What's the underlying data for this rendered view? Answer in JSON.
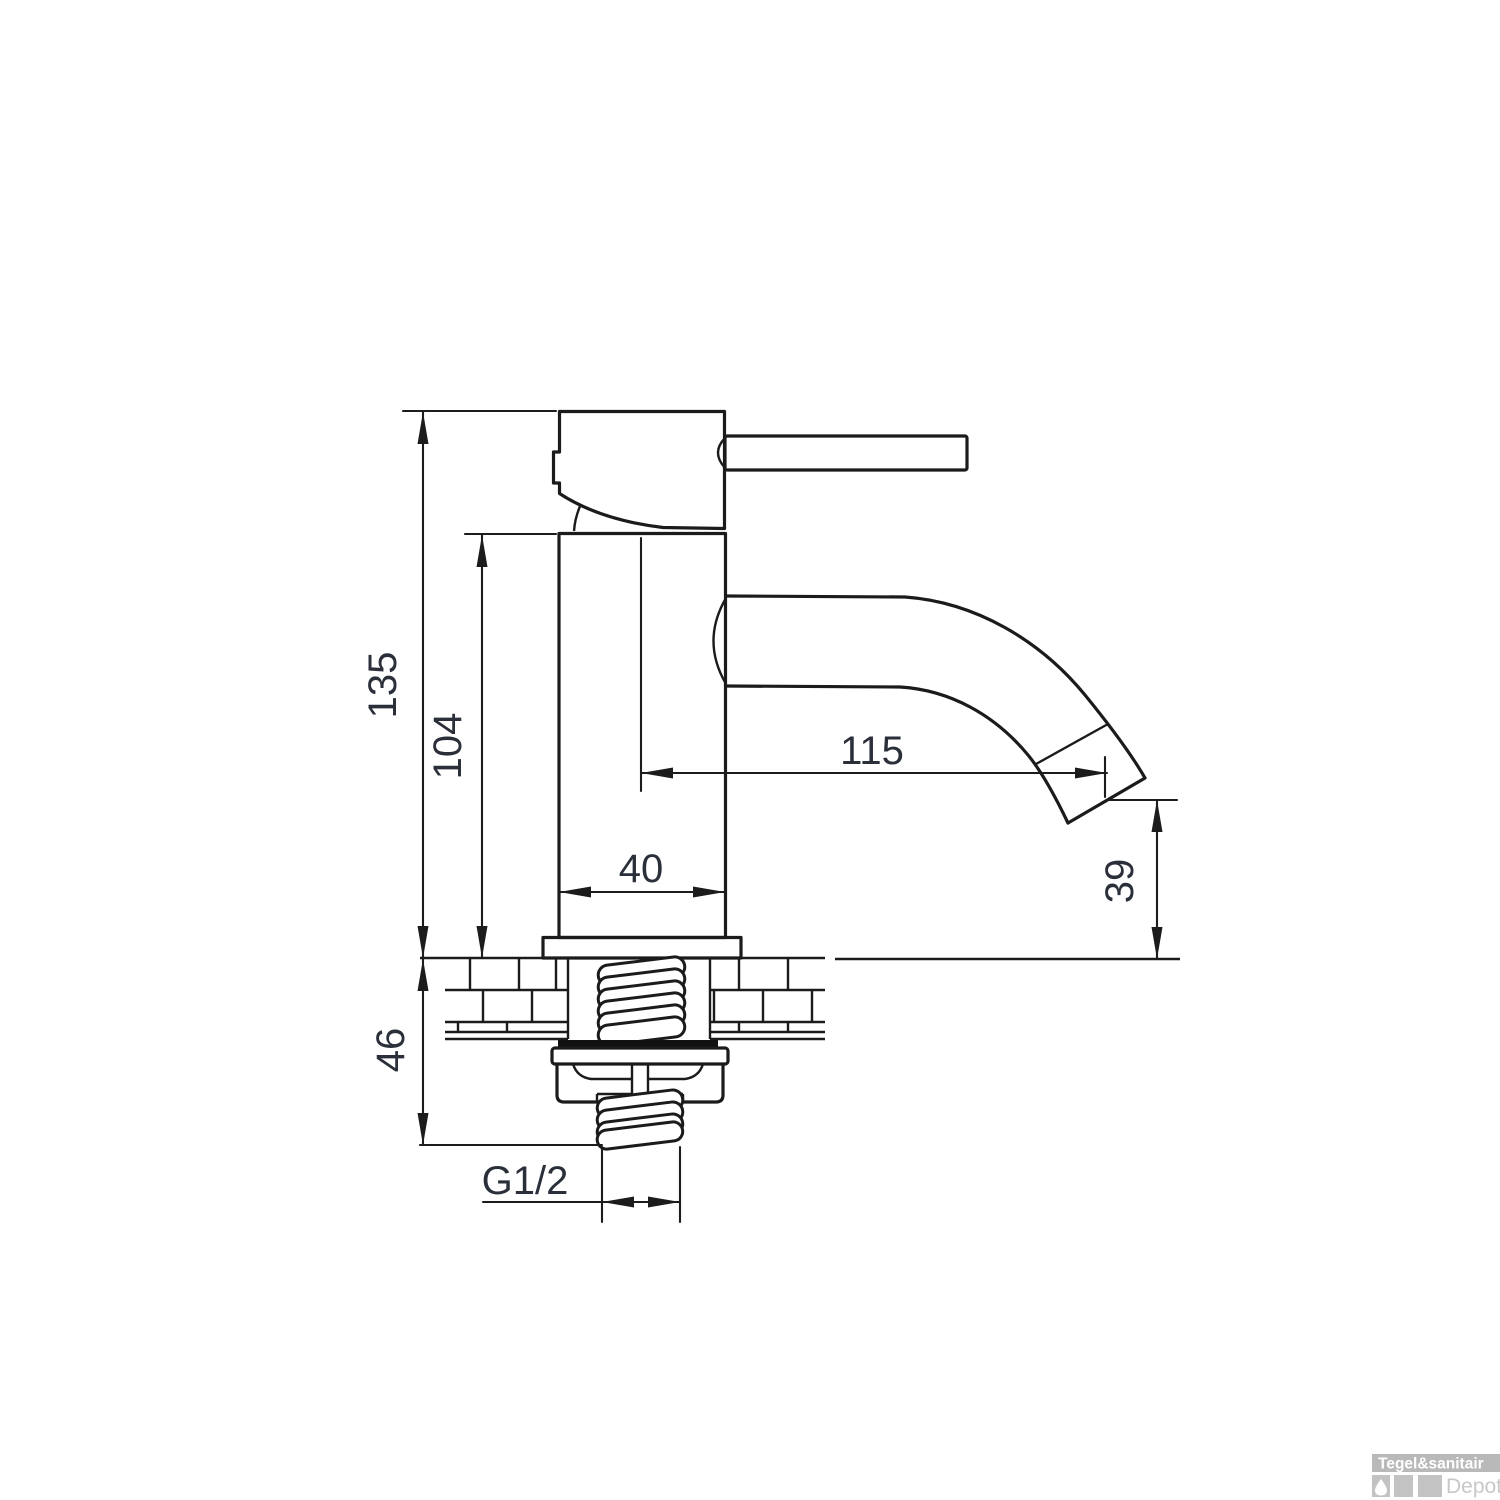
{
  "drawing": {
    "title": "faucet-technical-drawing",
    "dimensions": {
      "total_height": "135",
      "body_height": "104",
      "spout_reach": "115",
      "body_width": "40",
      "spout_outlet_height": "39",
      "mounting_depth": "46",
      "thread_size": "G1/2"
    },
    "line_color": "#1b1b1b",
    "text_color": "#2a2f3a"
  },
  "watermark": {
    "line1": "Tegel&sanitair",
    "line2": "Depot",
    "box_color": "#b9b9b9",
    "square_color": "#c3c3c3",
    "depot_text_color": "#c8c8c8"
  }
}
